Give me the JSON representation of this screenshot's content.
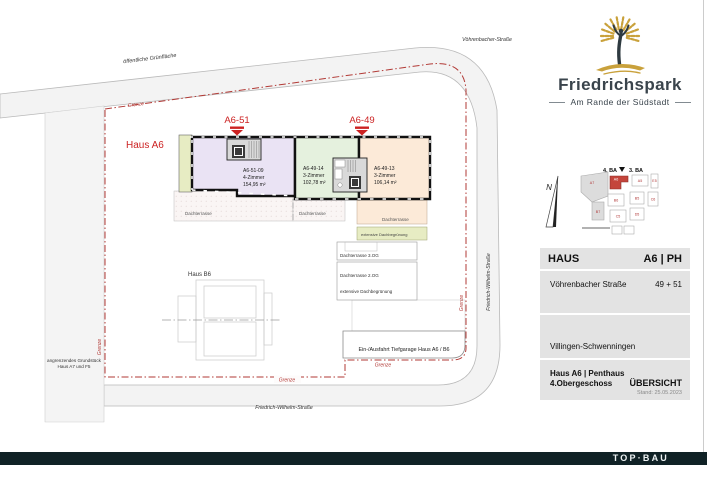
{
  "branding": {
    "name": "Friedrichspark",
    "tagline": "Am Rande der Südstadt",
    "text_color": "#3a444c",
    "gold": "#c9a13b"
  },
  "site": {
    "green_area_label": "öffentliche Grünfläche",
    "voehrenbacher_label": "Vöhrenbacher-Straße",
    "fw_street_right_label": "Friedrich-Wilhelm-Straße",
    "fw_street_bottom_label": "Friedrich-Wilhelm-Straße",
    "grenze_label": "Grenze",
    "haus_a6_label": "Haus A6",
    "haus_b6_label": "Haus B6",
    "adjacent_line1": "angrenzendes Grundstück",
    "adjacent_line2": "Haus  A7 und F5",
    "driveway_label": "Ein-/Ausfahrt Tiefgarage Haus A6 / B6",
    "marker_left": "A6-51",
    "marker_right": "A6-49",
    "units": [
      {
        "id": "A6-51-09",
        "rooms": "4-Zimmer",
        "area": "154,95 m²"
      },
      {
        "id": "A6-49-14",
        "rooms": "3-Zimmer",
        "area": "102,78 m²"
      },
      {
        "id": "A6-49-13",
        "rooms": "3-Zimmer",
        "area": "106,14 m²"
      }
    ],
    "terrace_label": "Dachterrasse",
    "roof_green_label": "extensive Dachbegrünung",
    "terrace_3og_label": "Dachterrasse 3.OG",
    "terrace_2og_label": "Dachterrasse 2.OG"
  },
  "minimap": {
    "north_label": "N",
    "ba4": "4. BA",
    "ba3": "3. BA",
    "buildings": [
      "A7",
      "A6",
      "A5",
      "E5",
      "B7",
      "B6",
      "B5",
      "C6",
      "C5",
      "D5"
    ]
  },
  "titleblock": {
    "row1_label": "HAUS",
    "row1_value": "A6 | PH",
    "row2_label": "Vöhrenbacher Straße",
    "row2_value": "49 + 51",
    "row3_label": "Villingen-Schwenningen",
    "row4_line1": "Haus A6 | Penthaus",
    "row4_line2": "4.Obergeschoss",
    "row4_value": "ÜBERSICHT",
    "stand": "Stand: 25.05.2023"
  },
  "footer": {
    "logo_text": "TOP·BAU"
  },
  "colors": {
    "unit_purple": "#eae3f4",
    "unit_green": "#e5f1de",
    "unit_orange": "#fcead8",
    "roof_green": "#e7ecc3",
    "boundary_red": "#b23a36",
    "marker_red": "#cc2222",
    "road_fill": "#f3f3f3",
    "footer_bar": "#102226"
  }
}
